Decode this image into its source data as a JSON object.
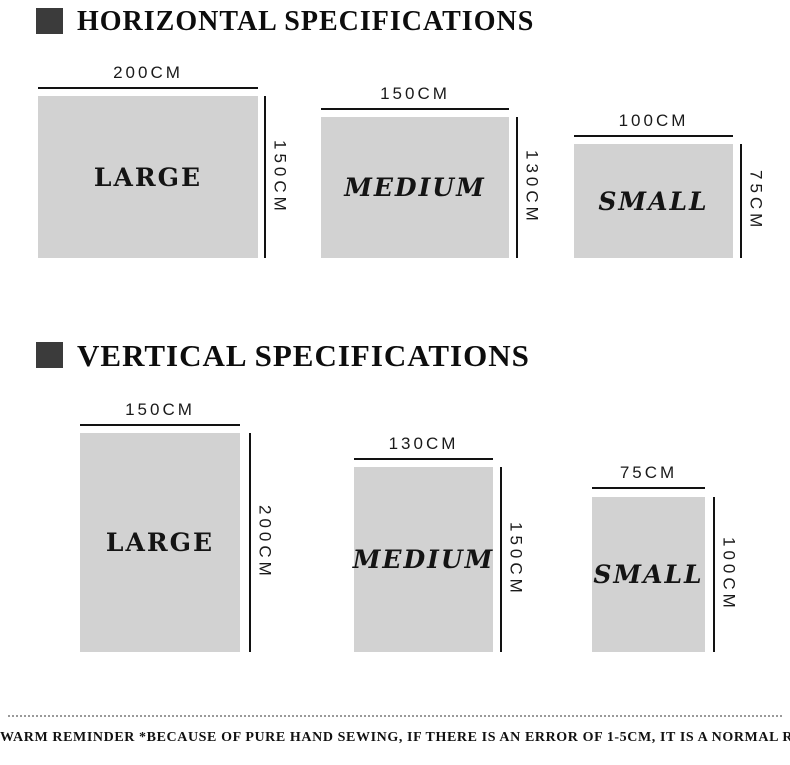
{
  "page": {
    "background_color": "#ffffff",
    "marker_color": "#3b3b3b",
    "rect_fill_color": "#d2d2d2",
    "dimension_line_color": "#121212",
    "dotted_line_color": "#9a9a9a"
  },
  "sections": [
    {
      "title": "HORIZONTAL SPECIFICATIONS",
      "items": [
        {
          "name": "LARGE",
          "width_label": "200CM",
          "height_label": "150CM"
        },
        {
          "name": "MEDIUM",
          "width_label": "150CM",
          "height_label": "130CM"
        },
        {
          "name": "SMALL",
          "width_label": "100CM",
          "height_label": "75CM"
        }
      ]
    },
    {
      "title": "VERTICAL SPECIFICATIONS",
      "items": [
        {
          "name": "LARGE",
          "width_label": "150CM",
          "height_label": "200CM"
        },
        {
          "name": "MEDIUM",
          "width_label": "130CM",
          "height_label": "150CM"
        },
        {
          "name": "SMALL",
          "width_label": "75CM",
          "height_label": "100CM"
        }
      ]
    }
  ],
  "footer": {
    "reminder": "WARM REMINDER *BECAUSE OF PURE HAND SEWING, IF THERE IS AN ERROR OF 1-5CM, IT IS A NORMAL RANGE!"
  }
}
